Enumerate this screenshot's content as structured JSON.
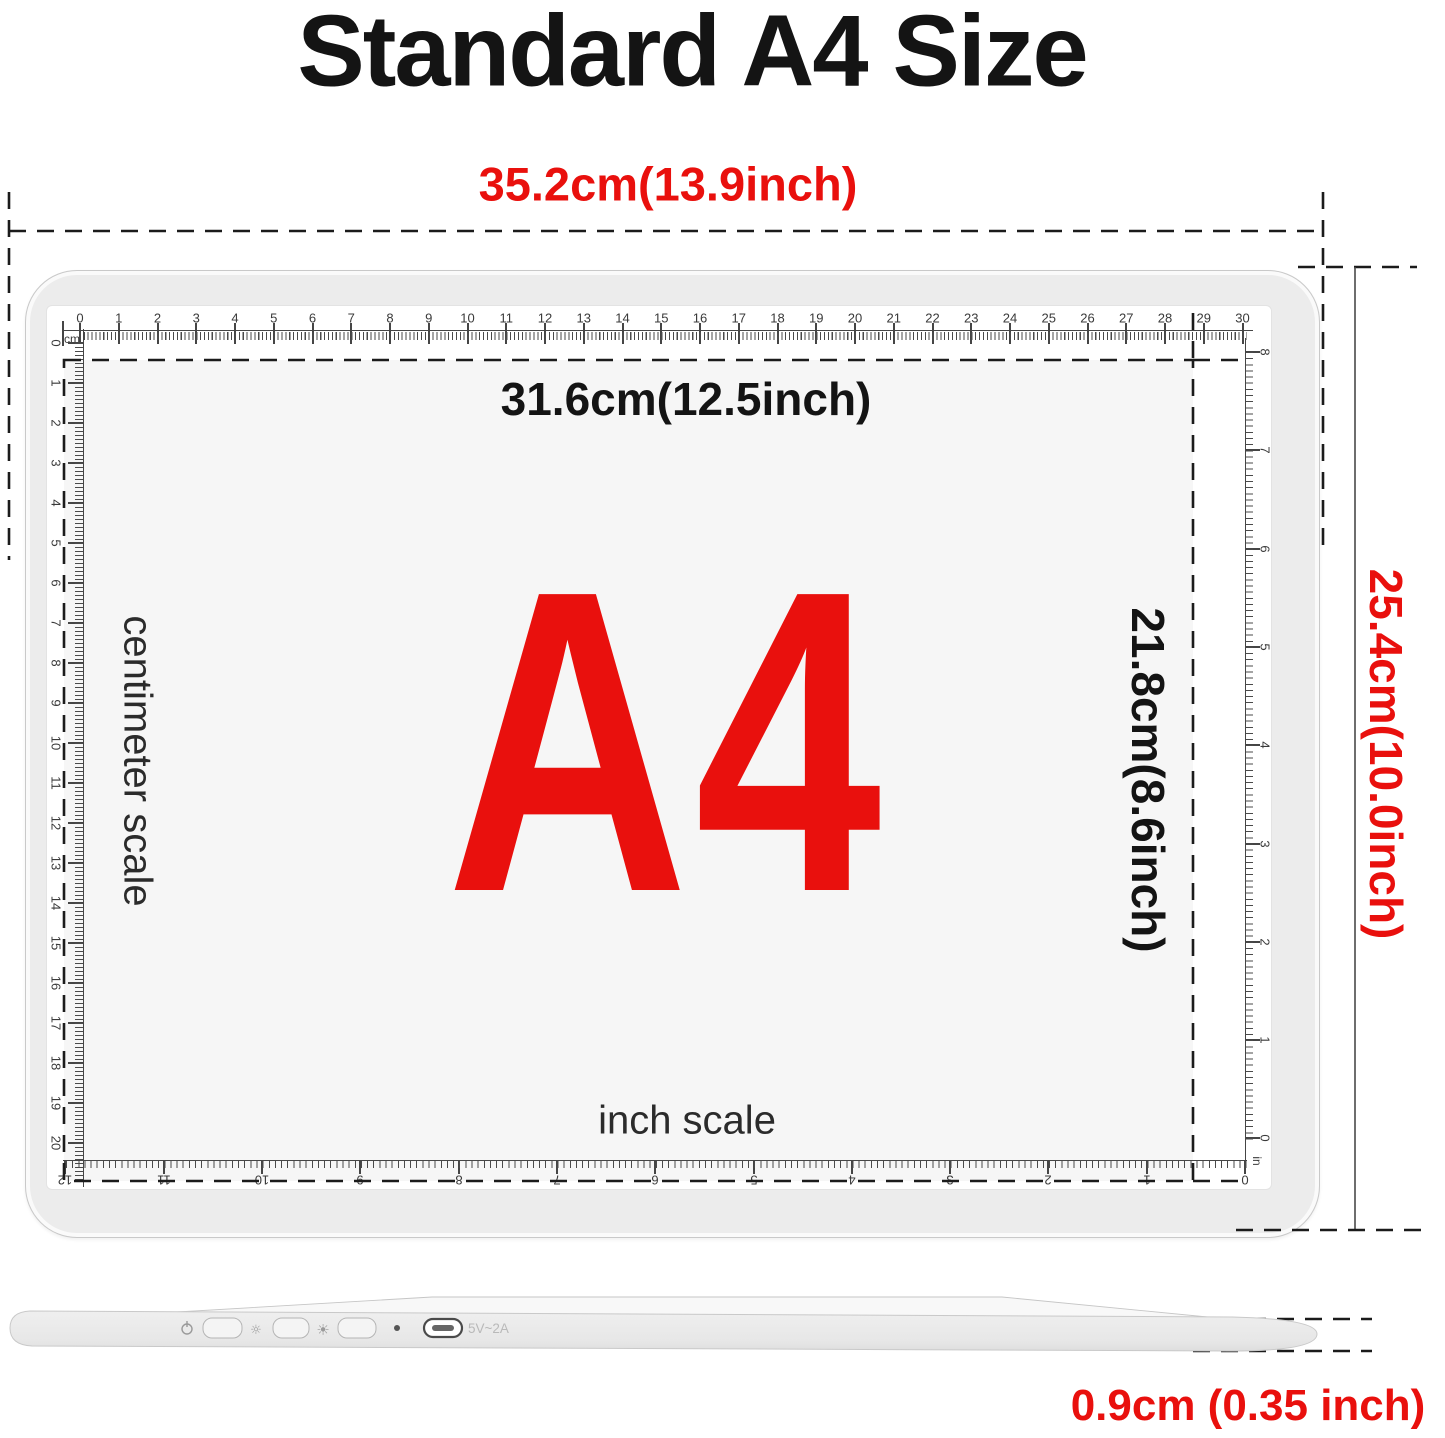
{
  "page": {
    "title": "Standard A4 Size"
  },
  "colors": {
    "accent_red": "#e9100d",
    "text_black": "#141414",
    "tick_gray": "#454545",
    "pad_bezel": "#ececec",
    "pad_screen": "#ffffff",
    "a4_surface": "#f6f6f6"
  },
  "dimensions": {
    "outer_width": "35.2cm(13.9inch)",
    "outer_height": "25.4cm(10.0inch)",
    "inner_width": "31.6cm(12.5inch)",
    "inner_height": "21.8cm(8.6inch)",
    "thickness": "0.9cm (0.35 inch)"
  },
  "pad": {
    "center_label": "A4",
    "cm_scale_caption": "centimeter scale",
    "inch_scale_caption": "inch scale",
    "rulers": {
      "top_cm": {
        "unit_label": "cm",
        "numbers": [
          0,
          1,
          2,
          3,
          4,
          5,
          6,
          7,
          8,
          9,
          10,
          11,
          12,
          13,
          14,
          15,
          16,
          17,
          18,
          19,
          20,
          21,
          22,
          23,
          24,
          25,
          26,
          27,
          28,
          29,
          30
        ]
      },
      "left_cm": {
        "numbers": [
          0,
          1,
          2,
          3,
          4,
          5,
          6,
          7,
          8,
          9,
          10,
          11,
          12,
          13,
          14,
          15,
          16,
          17,
          18,
          19,
          20
        ]
      },
      "right_inch": {
        "unit_label": "in",
        "numbers": [
          8,
          7,
          6,
          5,
          4,
          3,
          2,
          1,
          0
        ]
      },
      "bottom_inch": {
        "numbers": [
          12,
          11,
          10,
          9,
          8,
          7,
          6,
          5,
          4,
          3,
          2,
          1,
          0
        ]
      }
    }
  },
  "side_view": {
    "port_label": "5V~2A",
    "power_icon": "power",
    "brightness_low_icon": "sun-dim",
    "brightness_high_icon": "sun-bright",
    "usb_c_port": "usb-c-port"
  }
}
